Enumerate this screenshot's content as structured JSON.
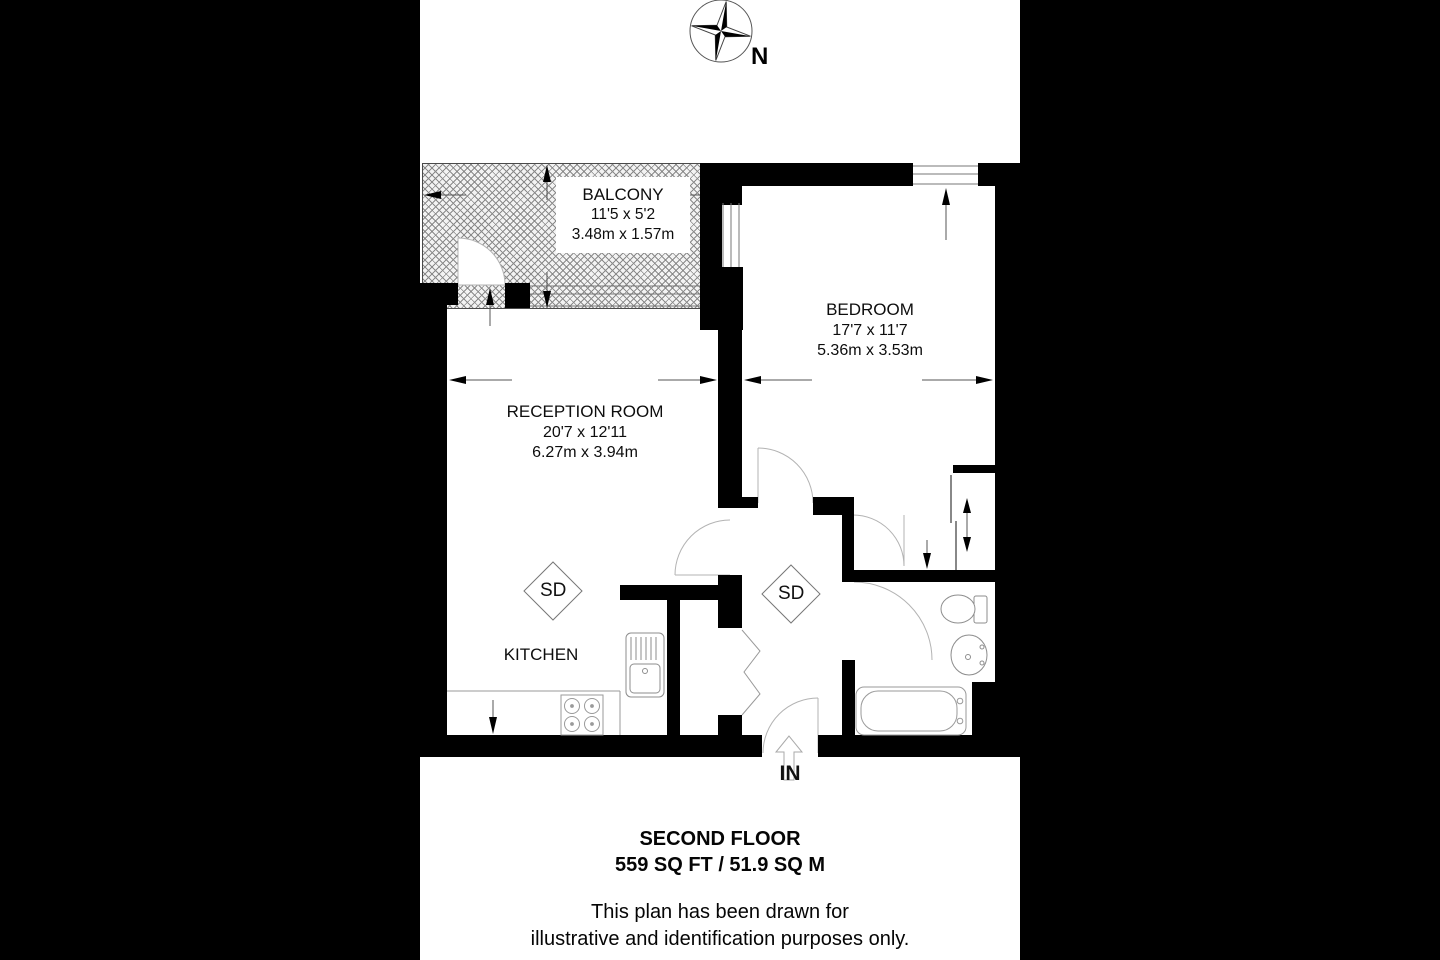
{
  "compass": {
    "north_label": "N"
  },
  "rooms": {
    "balcony": {
      "name": "BALCONY",
      "dims_imperial": "11'5 x 5'2",
      "dims_metric": "3.48m x 1.57m"
    },
    "bedroom": {
      "name": "BEDROOM",
      "dims_imperial": "17'7 x 11'7",
      "dims_metric": "5.36m x 3.53m"
    },
    "reception": {
      "name": "RECEPTION ROOM",
      "dims_imperial": "20'7 x 12'11",
      "dims_metric": "6.27m x 3.94m"
    },
    "kitchen": {
      "name": "KITCHEN"
    }
  },
  "markers": {
    "smoke_detector": "SD",
    "entrance": "IN"
  },
  "footer": {
    "floor_title": "SECOND FLOOR",
    "floor_area": "559 SQ FT / 51.9 SQ M",
    "disclaimer_line1": "This plan has been drawn for",
    "disclaimer_line2": "illustrative and identification purposes only."
  },
  "colors": {
    "background": "#000000",
    "plan_paper": "#ffffff",
    "walls": "#000000",
    "hatch_line": "#8a8a8a"
  }
}
